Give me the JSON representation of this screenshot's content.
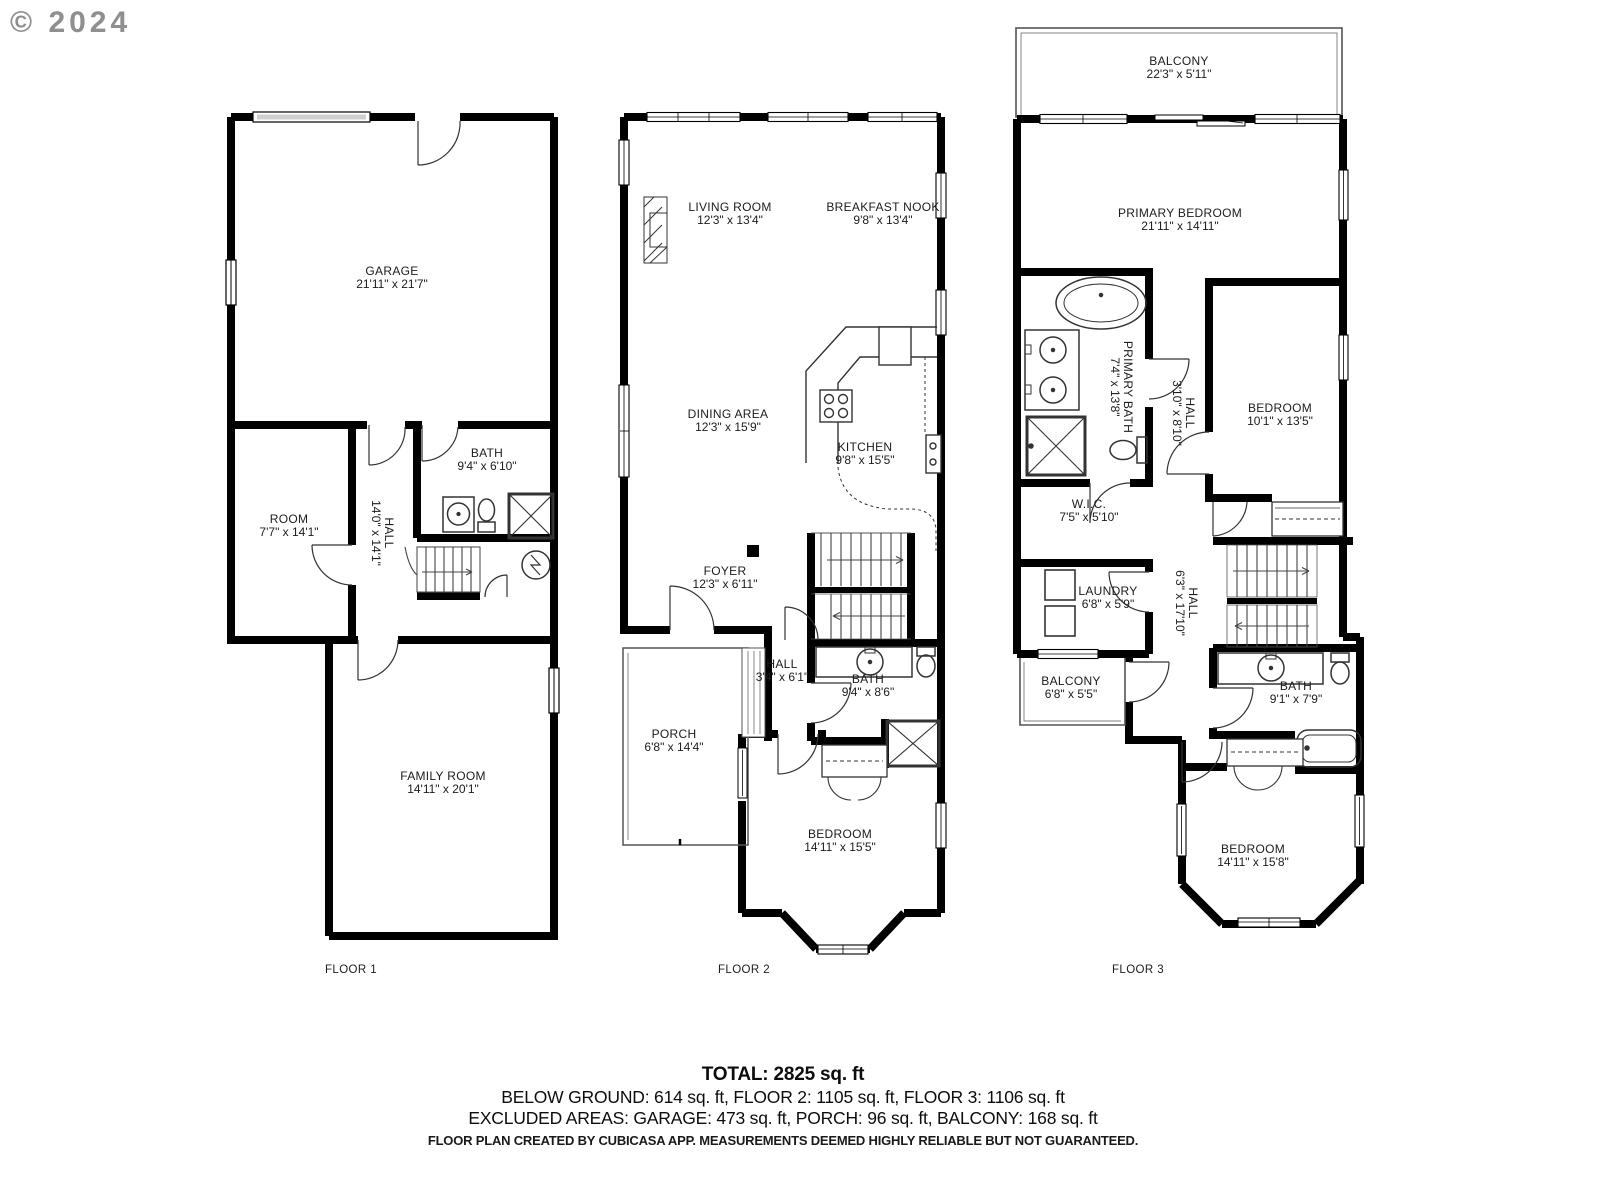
{
  "watermark": "© 2024",
  "floor1": {
    "label": "FLOOR 1",
    "rooms": {
      "garage": {
        "name": "GARAGE",
        "dims": "21'11\" x 21'7\""
      },
      "room": {
        "name": "ROOM",
        "dims": "7'7\" x 14'1\""
      },
      "hall": {
        "name": "HALL",
        "dims": "14'0\" x 14'1\""
      },
      "bath": {
        "name": "BATH",
        "dims": "9'4\" x 6'10\""
      },
      "family_room": {
        "name": "FAMILY ROOM",
        "dims": "14'11\" x 20'1\""
      }
    }
  },
  "floor2": {
    "label": "FLOOR 2",
    "rooms": {
      "living_room": {
        "name": "LIVING ROOM",
        "dims": "12'3\" x 13'4\""
      },
      "breakfast_nook": {
        "name": "BREAKFAST NOOK",
        "dims": "9'8\" x 13'4\""
      },
      "dining_area": {
        "name": "DINING AREA",
        "dims": "12'3\" x 15'9\""
      },
      "kitchen": {
        "name": "KITCHEN",
        "dims": "9'8\" x 15'5\""
      },
      "foyer": {
        "name": "FOYER",
        "dims": "12'3\" x 6'11\""
      },
      "hall": {
        "name": "HALL",
        "dims": "3'4\" x 6'1\""
      },
      "bath": {
        "name": "BATH",
        "dims": "9'4\" x 8'6\""
      },
      "porch": {
        "name": "PORCH",
        "dims": "6'8\" x 14'4\""
      },
      "bedroom": {
        "name": "BEDROOM",
        "dims": "14'11\" x 15'5\""
      }
    }
  },
  "floor3": {
    "label": "FLOOR 3",
    "rooms": {
      "balcony_top": {
        "name": "BALCONY",
        "dims": "22'3\" x 5'11\""
      },
      "primary_bedroom": {
        "name": "PRIMARY BEDROOM",
        "dims": "21'11\" x 14'11\""
      },
      "primary_bath": {
        "name": "PRIMARY BATH",
        "dims": "7'4\" x 13'8\""
      },
      "hall_upper": {
        "name": "HALL",
        "dims": "3'10\" x 8'10\""
      },
      "bedroom_small": {
        "name": "BEDROOM",
        "dims": "10'1\" x 13'5\""
      },
      "wic": {
        "name": "W.I.C.",
        "dims": "7'5\" x 5'10\""
      },
      "laundry": {
        "name": "LAUNDRY",
        "dims": "6'8\" x 5'9\""
      },
      "hall_lower": {
        "name": "HALL",
        "dims": "6'3\" x 17'10\""
      },
      "balcony_small": {
        "name": "BALCONY",
        "dims": "6'8\" x 5'5\""
      },
      "bath": {
        "name": "BATH",
        "dims": "9'1\" x 7'9\""
      },
      "bedroom_large": {
        "name": "BEDROOM",
        "dims": "14'11\" x 15'8\""
      }
    }
  },
  "summary": {
    "total": "TOTAL: 2825 sq. ft",
    "floors_line": "BELOW GROUND: 614 sq. ft, FLOOR 2: 1105 sq. ft, FLOOR 3: 1106 sq. ft",
    "excluded_line": "EXCLUDED AREAS: GARAGE: 473 sq. ft, PORCH: 96 sq. ft, BALCONY: 168 sq. ft",
    "disclaimer": "FLOOR PLAN CREATED BY CUBICASA APP. MEASUREMENTS DEEMED HIGHLY RELIABLE BUT NOT GUARANTEED."
  }
}
